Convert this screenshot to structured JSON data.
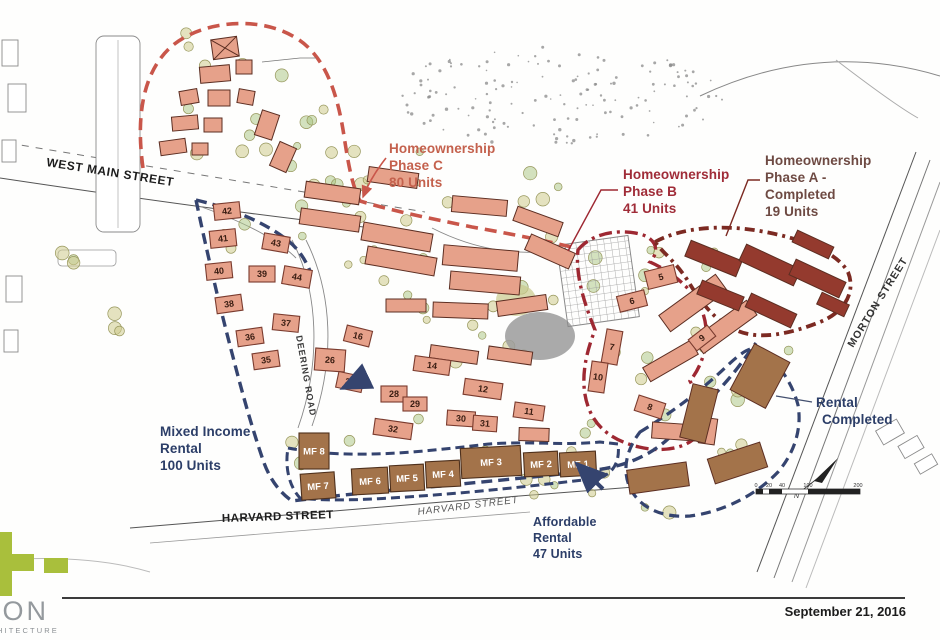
{
  "page": {
    "date": "September 21, 2016"
  },
  "logo": {
    "word": "CON",
    "sub": "RCHITECTURE",
    "green": "#a9bf3c"
  },
  "labels": {
    "phase_c": {
      "lines": [
        "Homeownership",
        "Phase C",
        "80 Units"
      ],
      "color": "#c4614d"
    },
    "phase_b": {
      "lines": [
        "Homeownership",
        "Phase B",
        "41 Units"
      ],
      "color": "#a02c38"
    },
    "phase_a": {
      "lines": [
        "Homeownership",
        "Phase A -",
        "Completed",
        "19 Units"
      ],
      "color": "#6e4a43"
    },
    "mixed_income": {
      "lines": [
        "Mixed Income",
        "Rental",
        "100 Units"
      ],
      "color": "#2c3e68"
    },
    "rental_completed": {
      "lines": [
        "Rental",
        "Completed"
      ],
      "color": "#2c3e68"
    },
    "affordable": {
      "lines": [
        "Affordable",
        "Rental",
        "47 Units"
      ],
      "color": "#2c3e68"
    }
  },
  "streets": {
    "west_main": "WEST MAIN STREET",
    "harvard_a": "HARVARD STREET",
    "harvard_b": "HARVARD STREET",
    "morton": "MORTON STREET",
    "deering": "DEERING ROAD"
  },
  "compass": {
    "north_label": "N"
  },
  "scale_bar": {
    "ticks": [
      "0",
      "20",
      "40",
      "100",
      "200"
    ]
  },
  "plan": {
    "colors": {
      "salmon_fill": "#e6a18a",
      "salmon_stroke": "#7a3b2e",
      "darkred_fill": "#943a2e",
      "brown_fill": "#a3734a",
      "boundary_phase_c": "#c9564a",
      "boundary_phase_b": "#9e2832",
      "boundary_phase_a": "#7c2a22",
      "boundary_rental": "#35446f"
    },
    "numbered_buildings": [
      {
        "label": "42",
        "x": 214,
        "y": 203,
        "w": 26,
        "h": 16,
        "r": -6
      },
      {
        "label": "41",
        "x": 210,
        "y": 230,
        "w": 26,
        "h": 17,
        "r": -6
      },
      {
        "label": "40",
        "x": 206,
        "y": 263,
        "w": 26,
        "h": 16,
        "r": -6
      },
      {
        "label": "39",
        "x": 249,
        "y": 266,
        "w": 26,
        "h": 16,
        "r": 0
      },
      {
        "label": "43",
        "x": 263,
        "y": 235,
        "w": 26,
        "h": 16,
        "r": 10
      },
      {
        "label": "44",
        "x": 283,
        "y": 268,
        "w": 28,
        "h": 18,
        "r": 10
      },
      {
        "label": "38",
        "x": 216,
        "y": 296,
        "w": 26,
        "h": 16,
        "r": -8
      },
      {
        "label": "37",
        "x": 273,
        "y": 315,
        "w": 26,
        "h": 16,
        "r": 6
      },
      {
        "label": "36",
        "x": 237,
        "y": 329,
        "w": 26,
        "h": 16,
        "r": -8
      },
      {
        "label": "35",
        "x": 253,
        "y": 352,
        "w": 26,
        "h": 16,
        "r": -8
      },
      {
        "label": "26",
        "x": 315,
        "y": 349,
        "w": 30,
        "h": 22,
        "r": 4
      },
      {
        "label": "27",
        "x": 337,
        "y": 374,
        "w": 26,
        "h": 16,
        "r": 12
      },
      {
        "label": "16",
        "x": 345,
        "y": 328,
        "w": 26,
        "h": 16,
        "r": 14
      },
      {
        "label": "28",
        "x": 381,
        "y": 386,
        "w": 26,
        "h": 16,
        "r": 0
      },
      {
        "label": "29",
        "x": 403,
        "y": 397,
        "w": 24,
        "h": 14,
        "r": 0
      },
      {
        "label": "32",
        "x": 374,
        "y": 421,
        "w": 38,
        "h": 16,
        "r": 8
      },
      {
        "label": "30",
        "x": 447,
        "y": 411,
        "w": 28,
        "h": 15,
        "r": 4
      },
      {
        "label": "31",
        "x": 473,
        "y": 416,
        "w": 24,
        "h": 15,
        "r": 4
      },
      {
        "label": "14",
        "x": 414,
        "y": 358,
        "w": 36,
        "h": 15,
        "r": 8
      },
      {
        "label": "12",
        "x": 464,
        "y": 381,
        "w": 38,
        "h": 16,
        "r": 8
      },
      {
        "label": "11",
        "x": 514,
        "y": 404,
        "w": 30,
        "h": 15,
        "r": 8
      },
      {
        "label": "5",
        "x": 646,
        "y": 268,
        "w": 30,
        "h": 18,
        "r": -14
      },
      {
        "label": "6",
        "x": 618,
        "y": 293,
        "w": 28,
        "h": 16,
        "r": -14
      },
      {
        "label": "7",
        "x": 604,
        "y": 330,
        "w": 16,
        "h": 34,
        "r": 10
      },
      {
        "label": "10",
        "x": 590,
        "y": 362,
        "w": 16,
        "h": 30,
        "r": 8
      },
      {
        "label": "8",
        "x": 636,
        "y": 399,
        "w": 28,
        "h": 16,
        "r": 18
      },
      {
        "label": "9",
        "x": 690,
        "y": 331,
        "w": 24,
        "h": 14,
        "r": -38
      }
    ],
    "mf_buildings": [
      {
        "label": "MF 8",
        "x": 299,
        "y": 433,
        "w": 30,
        "h": 36,
        "r": 0
      },
      {
        "label": "MF 7",
        "x": 301,
        "y": 473,
        "w": 34,
        "h": 26,
        "r": -4
      },
      {
        "label": "MF 6",
        "x": 352,
        "y": 468,
        "w": 36,
        "h": 26,
        "r": -3
      },
      {
        "label": "MF 5",
        "x": 390,
        "y": 465,
        "w": 34,
        "h": 26,
        "r": -3
      },
      {
        "label": "MF 4",
        "x": 426,
        "y": 461,
        "w": 34,
        "h": 26,
        "r": -3
      },
      {
        "label": "MF 3",
        "x": 461,
        "y": 447,
        "w": 60,
        "h": 30,
        "r": -3
      },
      {
        "label": "MF 2",
        "x": 524,
        "y": 452,
        "w": 34,
        "h": 24,
        "r": -3
      },
      {
        "label": "MF 1",
        "x": 560,
        "y": 452,
        "w": 36,
        "h": 24,
        "r": -3
      }
    ]
  }
}
